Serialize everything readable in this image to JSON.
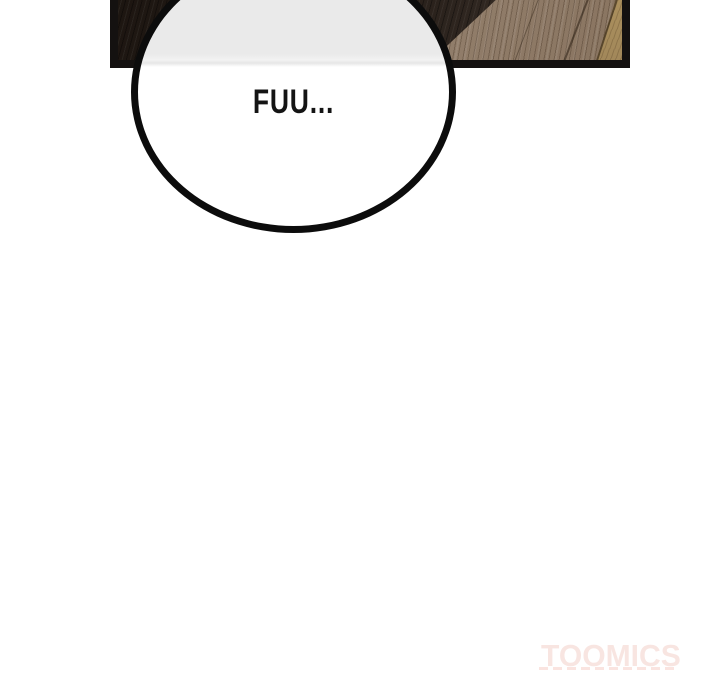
{
  "comic": {
    "panel": {
      "border_color": "#141110",
      "wood_dark_color": "#2c241c",
      "wood_light_color": "#93806d",
      "wood_accent_plank_color": "#a58a58"
    },
    "speech_bubble": {
      "text": "FUU...",
      "outline_color": "#0c0c0c",
      "fill_top_color": "#eaeaea",
      "fill_bottom_color": "#ffffff"
    }
  },
  "watermark": {
    "label": "TOOMICS",
    "color": "#f8e5e1"
  }
}
